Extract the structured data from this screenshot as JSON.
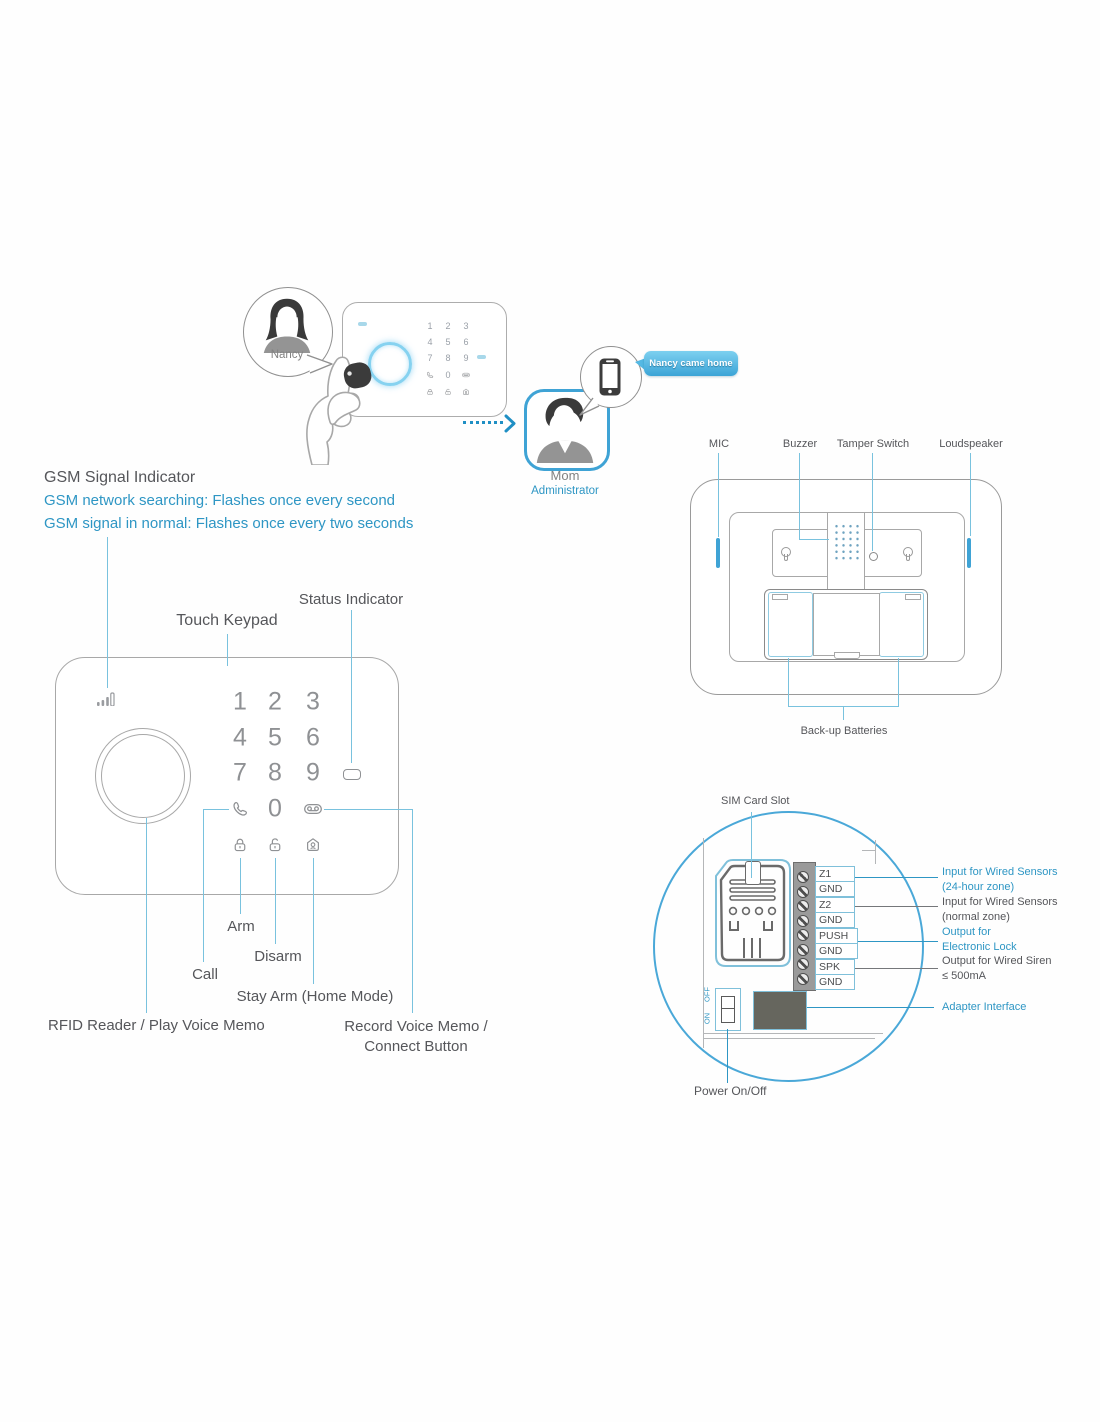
{
  "scenario": {
    "nancy": "Nancy",
    "mom": "Mom",
    "mom_role": "Administrator",
    "notification": "Nancy came home"
  },
  "gsm": {
    "title": "GSM Signal Indicator",
    "searching": "GSM network searching: Flashes once every second",
    "normal": "GSM signal in normal: Flashes once every two seconds"
  },
  "keypad": {
    "touch_label": "Touch Keypad",
    "status_label": "Status Indicator",
    "digits": [
      "1",
      "2",
      "3",
      "4",
      "5",
      "6",
      "7",
      "8",
      "9"
    ],
    "zero": "0",
    "arm": "Arm",
    "disarm": "Disarm",
    "call": "Call",
    "stay_arm": "Stay Arm (Home Mode)",
    "rfid": "RFID Reader / Play Voice Memo",
    "record1": "Record Voice Memo /",
    "record2": "Connect Button"
  },
  "back_view": {
    "mic": "MIC",
    "buzzer": "Buzzer",
    "tamper_switch": "Tamper Switch",
    "loudspeaker": "Loudspeaker",
    "backup_batteries": "Back-up Batteries"
  },
  "board": {
    "sim_card_slot": "SIM Card Slot",
    "terminals": [
      "Z1",
      "GND",
      "Z2",
      "GND",
      "PUSH",
      "GND",
      "SPK",
      "GND"
    ],
    "annotations": [
      {
        "line1": "Input for Wired Sensors",
        "line2": "(24-hour zone)"
      },
      {
        "line1": "Input for Wired Sensors",
        "line2": "(normal zone)"
      },
      {
        "line1": "Output for",
        "line2": "Electronic Lock"
      },
      {
        "line1": "Output for Wired Siren",
        "line2": "≤ 500mA"
      }
    ],
    "adapter_interface": "Adapter Interface",
    "power_on_off": "Power On/Off",
    "switch": {
      "on": "ON",
      "off": "OFF"
    }
  },
  "icons": {
    "signal": "gsm-signal-bars",
    "call_key": "phone-handset",
    "record_key": "voicemail",
    "arm_key": "closed-padlock",
    "disarm_key": "open-padlock",
    "stay_key": "house-person",
    "status": "status-led"
  },
  "colors": {
    "text_blue": "#2e96c4",
    "line_blue": "#79c2de",
    "frame_blue": "#3fa3d5",
    "text_dark": "#55565a",
    "outline_gray": "#a8a8a8",
    "digit_gray": "#8f9194"
  }
}
